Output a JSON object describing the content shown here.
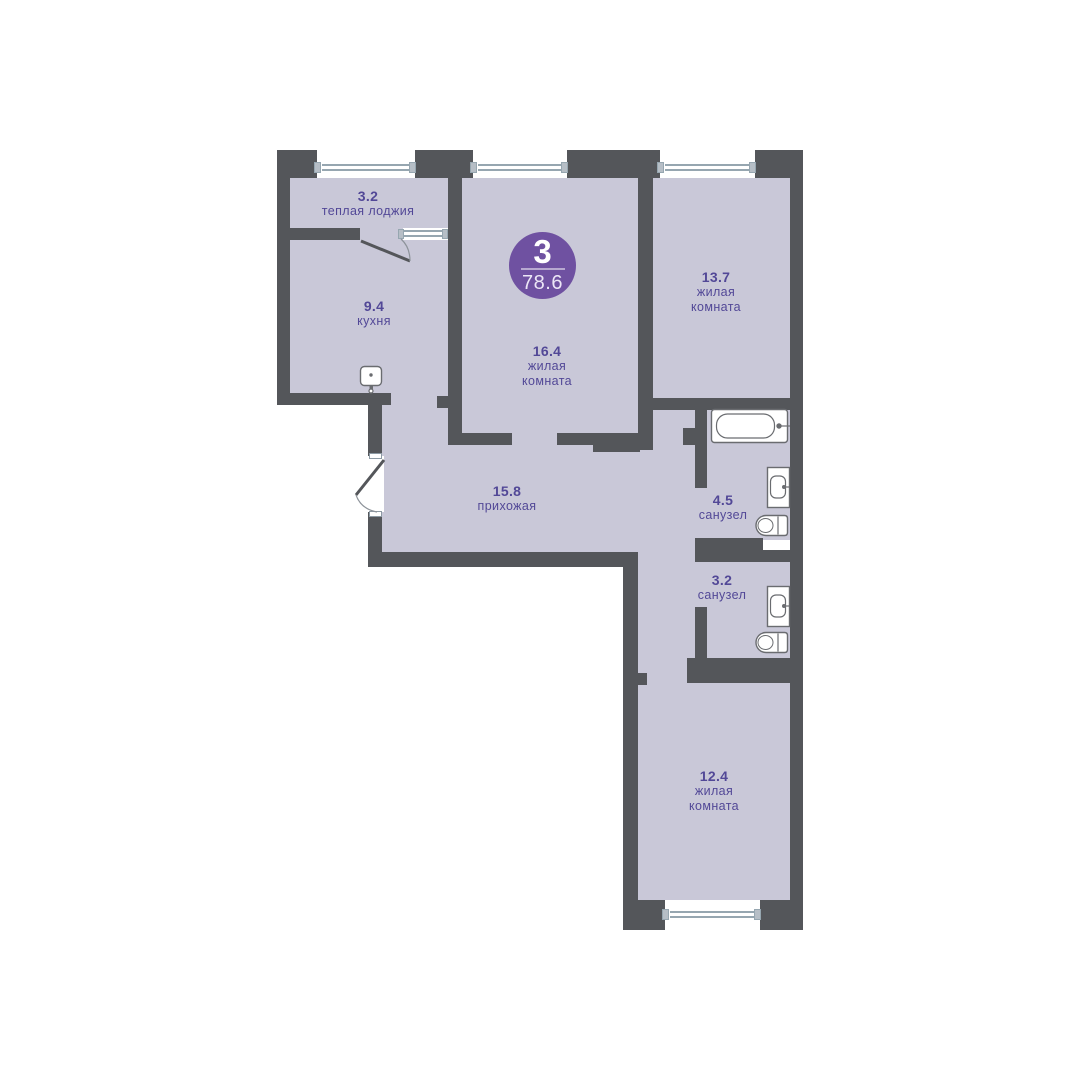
{
  "floor_plan": {
    "badge": {
      "rooms_count": "3",
      "total_area": "78.6"
    },
    "rooms": {
      "loggia": {
        "area": "3.2",
        "label": "теплая лоджия"
      },
      "kitchen": {
        "area": "9.4",
        "label": "кухня"
      },
      "living_main": {
        "area": "16.4",
        "label_line1": "жилая",
        "label_line2": "комната"
      },
      "living_right": {
        "area": "13.7",
        "label_line1": "жилая",
        "label_line2": "комната"
      },
      "hallway": {
        "area": "15.8",
        "label": "прихожая"
      },
      "bathroom_1": {
        "area": "4.5",
        "label": "санузел"
      },
      "bathroom_2": {
        "area": "3.2",
        "label": "санузел"
      },
      "living_bottom": {
        "area": "12.4",
        "label_line1": "жилая",
        "label_line2": "комната"
      }
    },
    "colors": {
      "wall": "#54565a",
      "room": "#c9c8d8",
      "accent": "#6f51a1",
      "ink": "#524897",
      "window": "#96a6b0",
      "fixture": "#6a6c70"
    }
  }
}
